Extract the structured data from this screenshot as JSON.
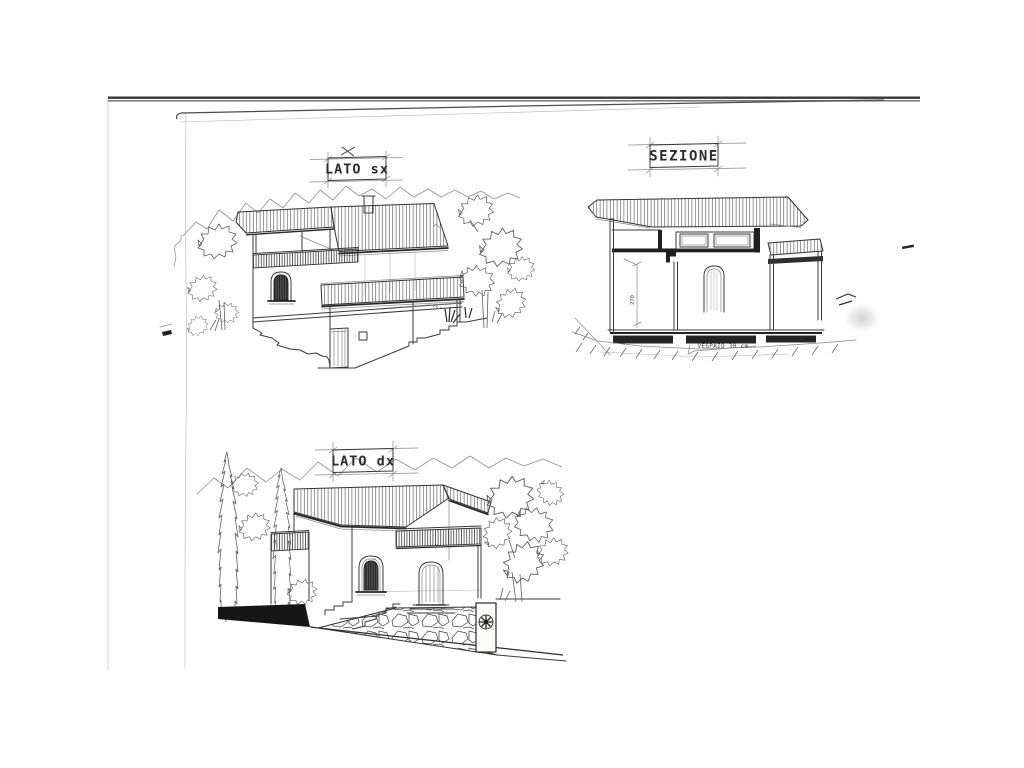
{
  "page": {
    "paper_color": "#ffffff",
    "ink_color": "#3a3a3a",
    "scan_edge_color": "#383838",
    "description": "Scanned hand-drawn architectural elevations and section of a hillside house"
  },
  "drawings": {
    "lato_sx": {
      "label": "LATO sx",
      "annotation_mark": "x"
    },
    "sezione": {
      "label": "SEZIONE",
      "height_dimension": "270",
      "foundation_note": "VESPAIO 30 cm"
    },
    "lato_dx": {
      "label": "LATO dx"
    }
  }
}
